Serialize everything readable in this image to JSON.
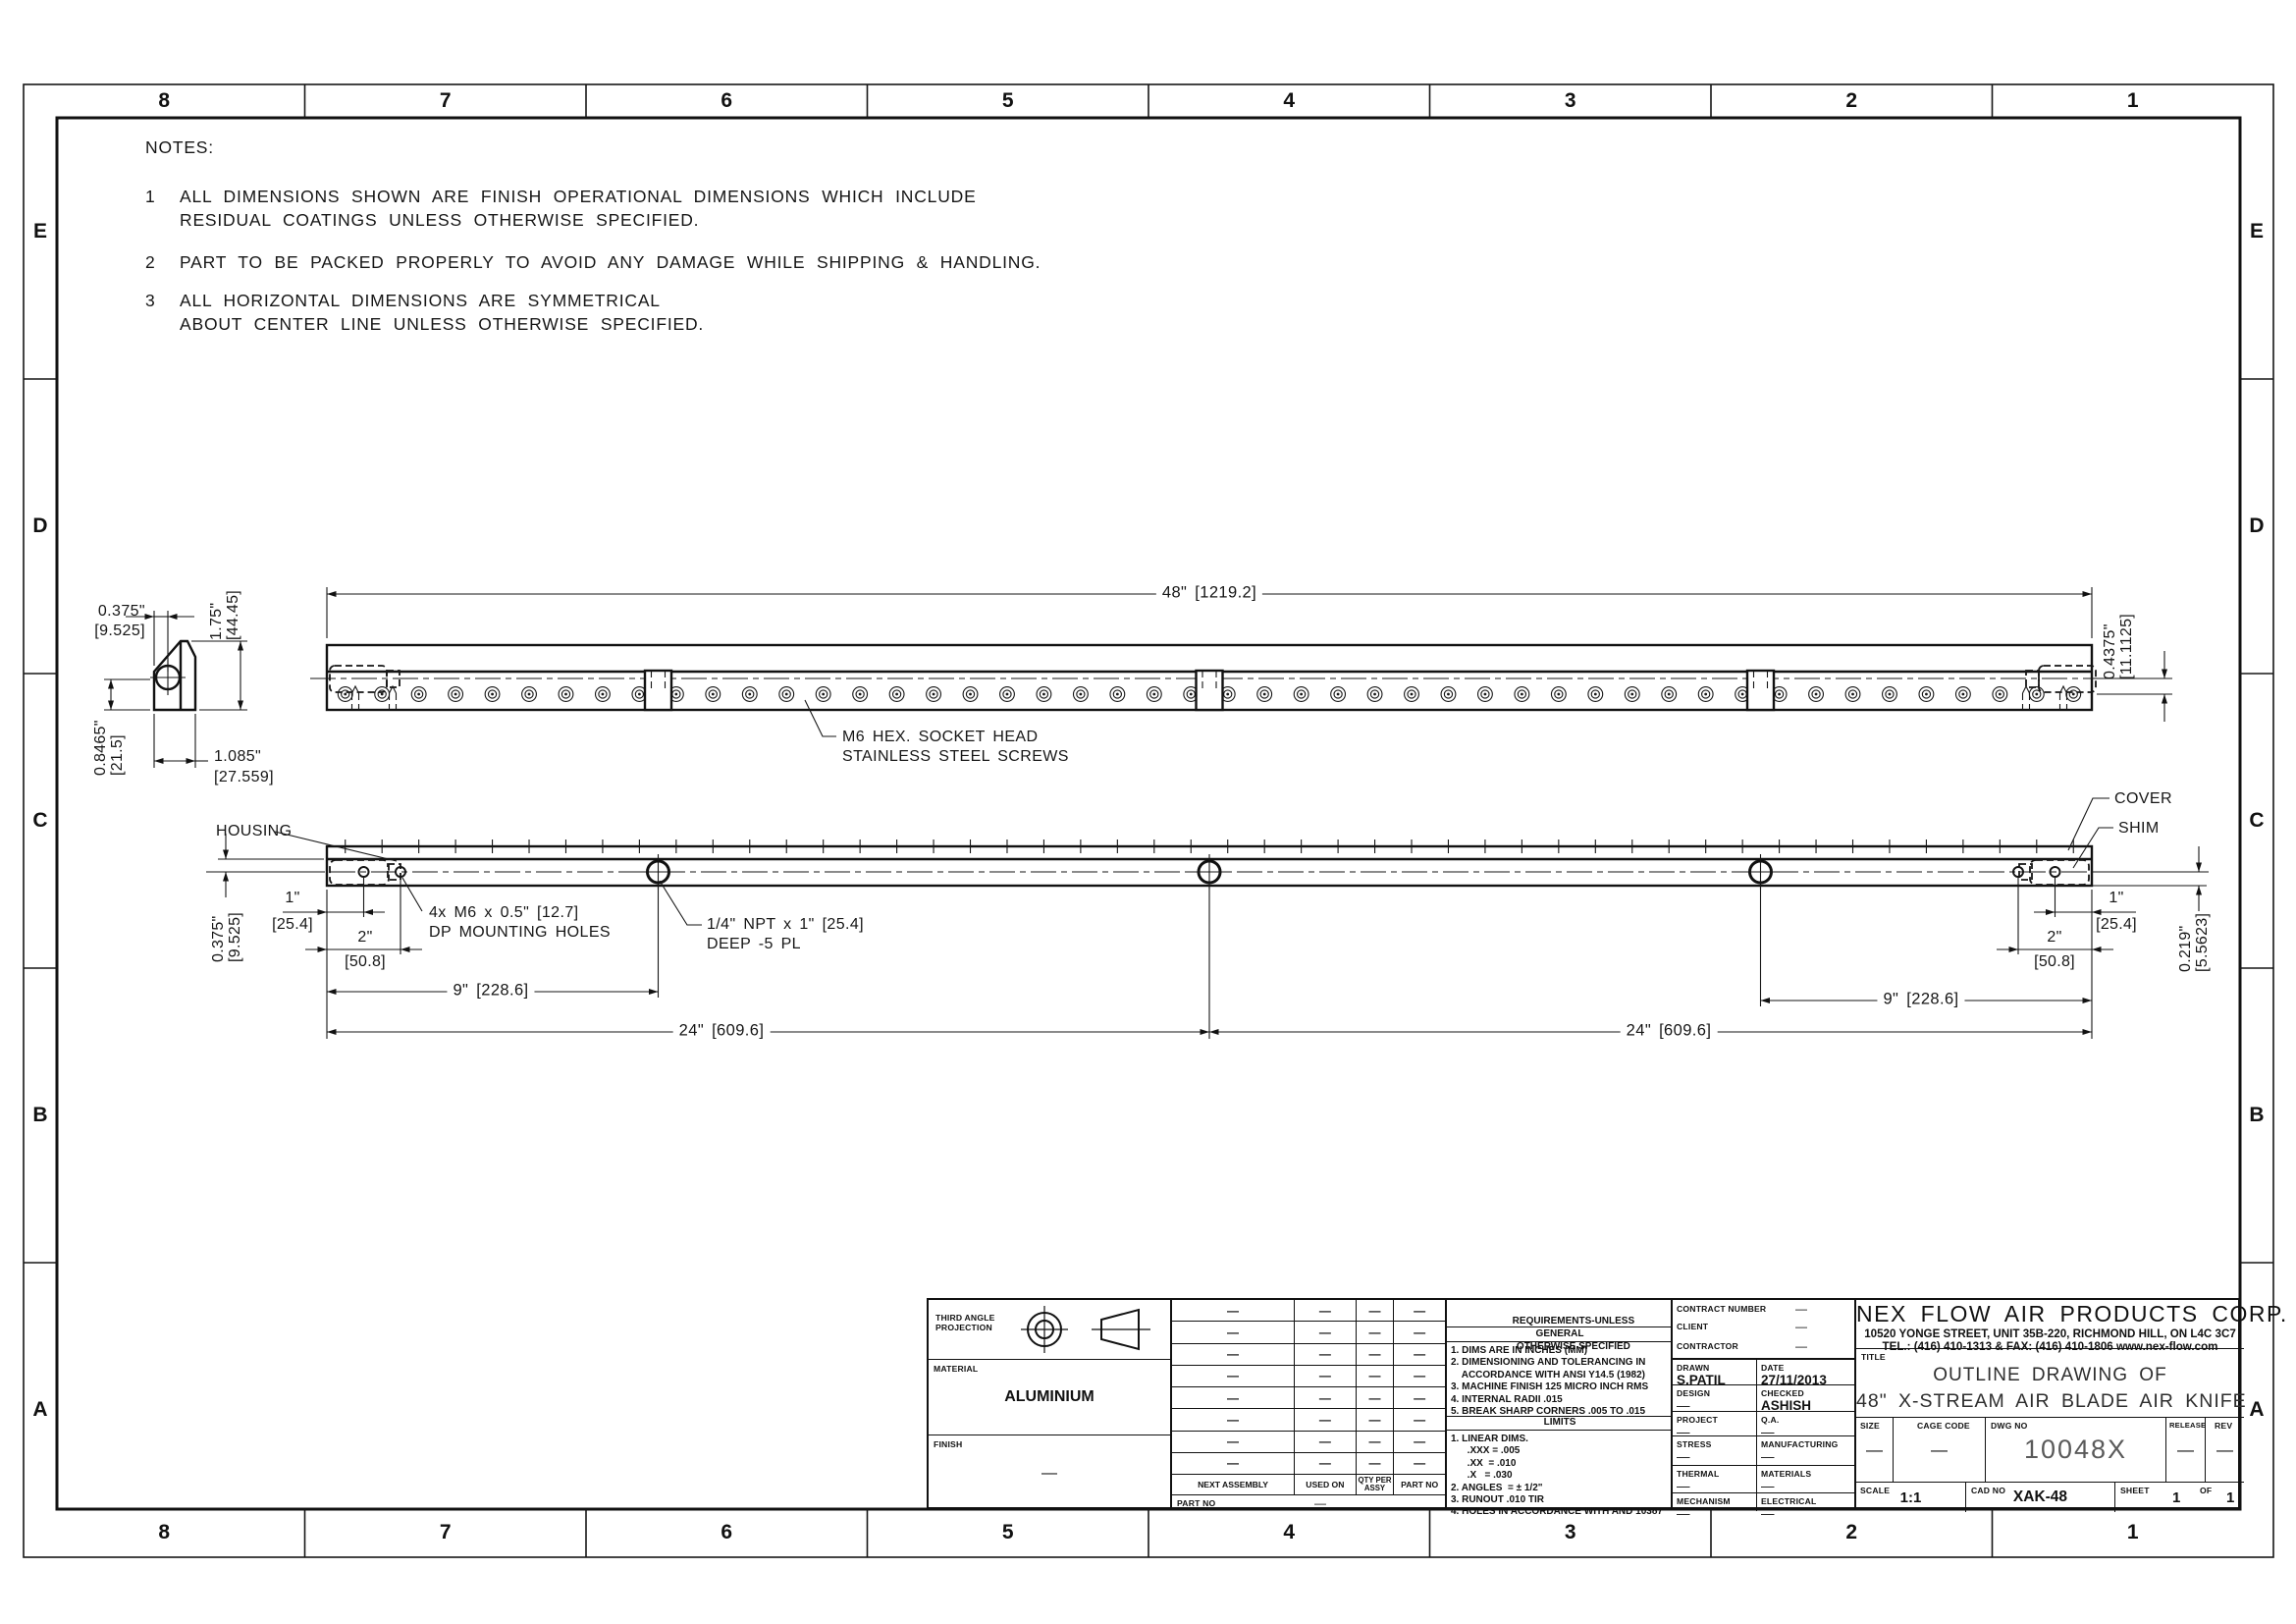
{
  "zones": {
    "columns": [
      "8",
      "7",
      "6",
      "5",
      "4",
      "3",
      "2",
      "1"
    ],
    "rows": [
      "E",
      "D",
      "C",
      "B",
      "A"
    ]
  },
  "notes": {
    "heading": "NOTES:",
    "items": [
      {
        "num": "1",
        "lines": [
          "ALL DIMENSIONS SHOWN ARE FINISH OPERATIONAL DIMENSIONS WHICH INCLUDE",
          "RESIDUAL COATINGS UNLESS OTHERWISE SPECIFIED."
        ]
      },
      {
        "num": "2",
        "lines": [
          "PART TO BE PACKED PROPERLY TO AVOID ANY DAMAGE WHILE SHIPPING & HANDLING."
        ]
      },
      {
        "num": "3",
        "lines": [
          "ALL HORIZONTAL DIMENSIONS ARE SYMMETRICAL",
          "ABOUT CENTER LINE UNLESS OTHERWISE SPECIFIED."
        ]
      }
    ]
  },
  "top_view": {
    "dim_length": "48\" [1219.2]",
    "screw_note_line1": "M6 HEX. SOCKET HEAD",
    "screw_note_line2": "STAINLESS STEEL SCREWS",
    "dim_right_in": "0.4375\"",
    "dim_right_mm": "[11.1125]"
  },
  "section_view": {
    "dim_top_in": "0.375\"",
    "dim_top_mm": "[9.525]",
    "dim_height_in": "1.75\"",
    "dim_height_mm": "[44.45]",
    "dim_left_in": "0.8465\"",
    "dim_left_mm": "[21.5]",
    "dim_width_in": "1.085\"",
    "dim_width_mm": "[27.559]"
  },
  "bottom_view": {
    "label_housing": "HOUSING",
    "label_cover": "COVER",
    "label_shim": "SHIM",
    "dim_left_v_in": "0.375\"",
    "dim_left_v_mm": "[9.525]",
    "dim_1_left_in": "1\"",
    "dim_1_left_mm": "[25.4]",
    "dim_2_left_in": "2\"",
    "dim_2_left_mm": "[50.8]",
    "note_holes_line1": "4x M6 x 0.5\" [12.7]",
    "note_holes_line2": "DP MOUNTING HOLES",
    "note_npt_line1": "1/4\" NPT x 1\" [25.4]",
    "note_npt_line2": "DEEP -5 PL",
    "dim_9_left": "9\" [228.6]",
    "dim_24_left": "24\" [609.6]",
    "dim_24_right": "24\" [609.6]",
    "dim_9_right": "9\" [228.6]",
    "dim_1_right_in": "1\"",
    "dim_1_right_mm": "[25.4]",
    "dim_2_right_in": "2\"",
    "dim_2_right_mm": "[50.8]",
    "dim_right_v_in": "0.219\"",
    "dim_right_v_mm": "[5.5623]"
  },
  "title_block": {
    "projection_line1": "THIRD ANGLE",
    "projection_line2": "PROJECTION",
    "material_label": "MATERIAL",
    "material_value": "ALUMINIUM",
    "finish_label": "FINISH",
    "finish_value": "—",
    "parts_table": {
      "headers": [
        "NEXT ASSEMBLY",
        "USED ON",
        "QTY PER ASSY",
        "PART NO"
      ],
      "rows": [
        [
          "—",
          "—",
          "—",
          "—"
        ],
        [
          "—",
          "—",
          "—",
          "—"
        ],
        [
          "—",
          "—",
          "—",
          "—"
        ],
        [
          "—",
          "—",
          "—",
          "—"
        ],
        [
          "—",
          "—",
          "—",
          "—"
        ],
        [
          "—",
          "—",
          "—",
          "—"
        ],
        [
          "—",
          "—",
          "—",
          "—"
        ],
        [
          "—",
          "—",
          "—",
          "—"
        ]
      ],
      "part_no_label": "PART NO",
      "part_no_value": "—"
    },
    "requirements": {
      "header_line1": "REQUIREMENTS-UNLESS",
      "header_line2": "OTHERWISE SPECIFIED",
      "general_label": "GENERAL",
      "general_items": [
        "1. DIMS ARE IN INCHES (MM)",
        "2. DIMENSIONING AND TOLERANCING IN",
        "    ACCORDANCE WITH ANSI Y14.5 (1982)",
        "3. MACHINE FINISH 125 MICRO INCH RMS",
        "4. INTERNAL RADII .015",
        "5. BREAK SHARP CORNERS .005 TO .015"
      ],
      "limits_label": "LIMITS",
      "limits_items": [
        "1. LINEAR DIMS.",
        "      .XXX = .005",
        "      .XX  = .010",
        "      .X   = .030",
        "2. ANGLES  = ± 1/2\"",
        "3. RUNOUT .010 TIR",
        "4. HOLES IN ACCORDANCE WITH AND 10387"
      ]
    },
    "admin": {
      "top_rows": [
        {
          "label": "CONTRACT NUMBER",
          "value": "—"
        },
        {
          "label": "CLIENT",
          "value": "—"
        },
        {
          "label": "CONTRACTOR",
          "value": "—"
        }
      ],
      "cells": [
        {
          "label": "DRAWN",
          "value": "S.PATIL"
        },
        {
          "label": "DATE",
          "value": "27/11/2013"
        },
        {
          "label": "DESIGN",
          "value": "—"
        },
        {
          "label": "CHECKED",
          "value": "ASHISH"
        },
        {
          "label": "PROJECT",
          "value": "—"
        },
        {
          "label": "Q.A.",
          "value": "—"
        },
        {
          "label": "STRESS",
          "value": "—"
        },
        {
          "label": "MANUFACTURING",
          "value": "—"
        },
        {
          "label": "THERMAL",
          "value": "—"
        },
        {
          "label": "MATERIALS",
          "value": "—"
        },
        {
          "label": "MECHANISM",
          "value": "—"
        },
        {
          "label": "ELECTRICAL",
          "value": "—"
        }
      ]
    },
    "company": {
      "name": "NEX FLOW AIR PRODUCTS CORP.",
      "address": "10520 YONGE STREET, UNIT 35B-220, RICHMOND HILL, ON L4C 3C7",
      "contact": "TEL.: (416) 410-1313 & FAX: (416) 410-1806 www.nex-flow.com",
      "title_label": "TITLE",
      "title_line1": "OUTLINE DRAWING OF",
      "title_line2": "48\" X-STREAM AIR BLADE AIR KNIFE",
      "size_label": "SIZE",
      "size_value": "—",
      "cage_code_label": "CAGE CODE",
      "cage_code_value": "—",
      "dwg_no_label": "DWG NO",
      "dwg_no_value": "10048X",
      "release_label": "RELEASE",
      "release_value": "—",
      "rev_label": "REV",
      "rev_value": "—",
      "scale_label": "SCALE",
      "scale_value": "1:1",
      "cad_no_label": "CAD NO",
      "cad_no_value": "XAK-48",
      "sheet_label": "SHEET",
      "sheet_value": "1",
      "of_label": "OF",
      "sheet_total": "1"
    }
  }
}
